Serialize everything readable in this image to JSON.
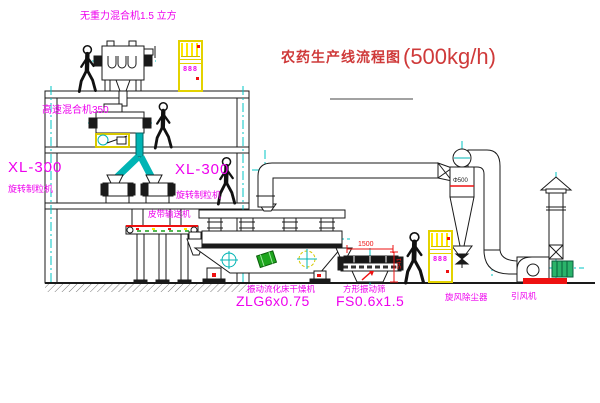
{
  "title": {
    "text": "农药生产线流程图",
    "capacity": "(500kg/h)"
  },
  "labels": {
    "mixer_top": "无重力混合机1.5 立方",
    "mixer_mid": "高速混合机350",
    "granulator_left": {
      "model": "XL-300",
      "name": "旋转制粒机"
    },
    "granulator_right": {
      "model": "XL-300",
      "name": "旋转制粒机"
    },
    "conveyor": "皮带输送机",
    "dryer": {
      "name": "振动流化床干燥机",
      "model": "ZLG6x0.75"
    },
    "sieve": {
      "name": "方形振动筛",
      "model": "FS0.6x1.5"
    },
    "cyclone": "旋风除尘器",
    "fan": "引风机"
  },
  "dimensions": {
    "sieve_length": "1500",
    "sieve_height": "541",
    "cyclone_spec": "Φ500"
  },
  "panel": {
    "glyphs": "888"
  },
  "colors": {
    "centerline_cyan": "#00c4c4",
    "label_magenta": "#ee00ee",
    "title_red": "#cf3a3a",
    "accent_red": "#ee1111",
    "cabinet_yellow": "#ffe800",
    "machine_green": "#1ea51e"
  }
}
